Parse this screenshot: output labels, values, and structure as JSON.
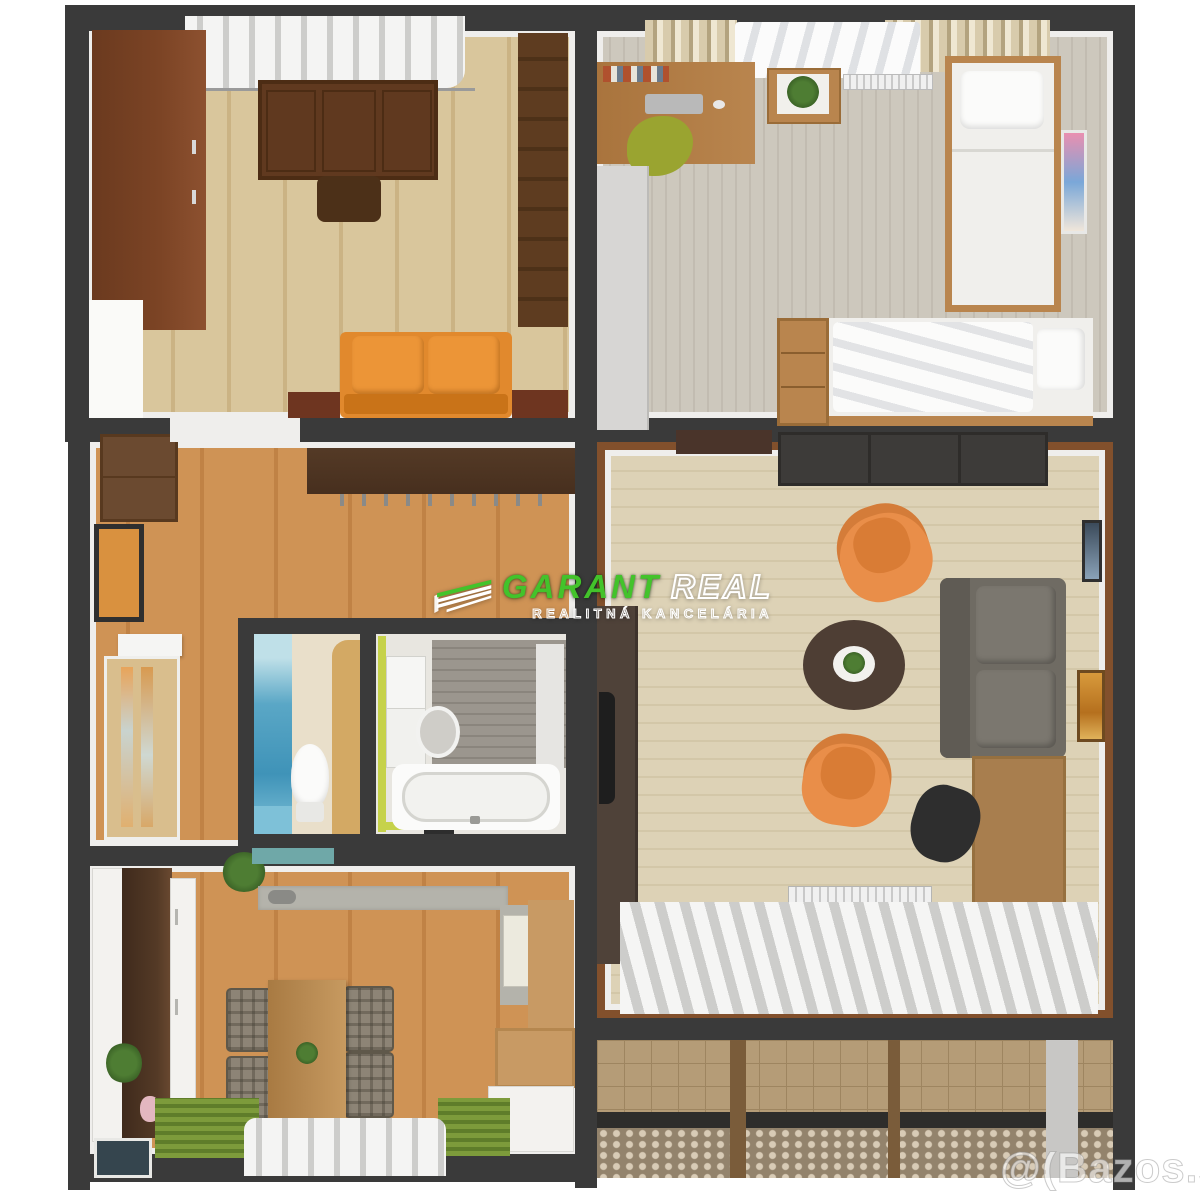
{
  "image": {
    "width": 1200,
    "height": 1196
  },
  "watermark_center": {
    "brand_first": "GARANT",
    "brand_second": "REAL",
    "subtitle": "REALITNÁ KANCELÁRIA",
    "logo_icon": "roof-layers-icon"
  },
  "watermark_corner": {
    "text": "@(Bazos.sk"
  },
  "palette": {
    "bg": "#ffffff",
    "wall": "#3a3a3a",
    "wall-face": "#efeeec",
    "floor-maple": "#d9c69c",
    "floor-maple-dark": "#cbb384",
    "carpet-gray": "#cdc8bd",
    "carpet-gray-stripe": "#c2bcb1",
    "floor-hall": "#cf9355",
    "floor-hall-dark": "#c08245",
    "floor-living": "#ddd2b6",
    "floor-living-line": "#d3c7a8",
    "living-border": "#82502c",
    "walnut": "#543a26",
    "wardrobe-red": "#7c4425",
    "desk-dark": "#60391f",
    "shelf-dark": "#5e3c20",
    "sofa-orange": "#e1892d",
    "sofa-orange-dark": "#c97318",
    "wood-mid": "#b9854e",
    "gray-unit": "#d7d6d4",
    "tv-unit": "#3d3b39",
    "tv-cab": "#4f4239",
    "coffee-table": "#4e3e34",
    "sofa-gray": "#6f6b63",
    "armchair": "#e98e49",
    "chair-black": "#2e2e2e",
    "desk-wood": "#a87e4e",
    "tile": "#b59c77",
    "tile-line": "#9e8560",
    "railing": "#93836c",
    "railing-dot": "#d8cbb6",
    "kitchen-white": "#f3f2ef",
    "counter-gray": "#b4b3ab",
    "rug-green": "#7d9b3b",
    "rug-green-dark": "#5f7d2a",
    "plaid": "#8d8476",
    "table-wood": "#b78a52",
    "poster-blue": "#5aa7c6",
    "trim-lime": "#c6d24a",
    "bath-gray": "#9b968e",
    "door-pine": "#d9be8d",
    "door-tan": "#d3a964",
    "green-chair": "#9aa430",
    "plant-green": "#4e7d33",
    "curtain-white": "#f4f4f3",
    "curtain-shade": "#cdcdcb",
    "curtain-tan": "#d8cbac",
    "curtain-tan-dark": "#b3a37f",
    "watermark-green": "#43c32b"
  }
}
